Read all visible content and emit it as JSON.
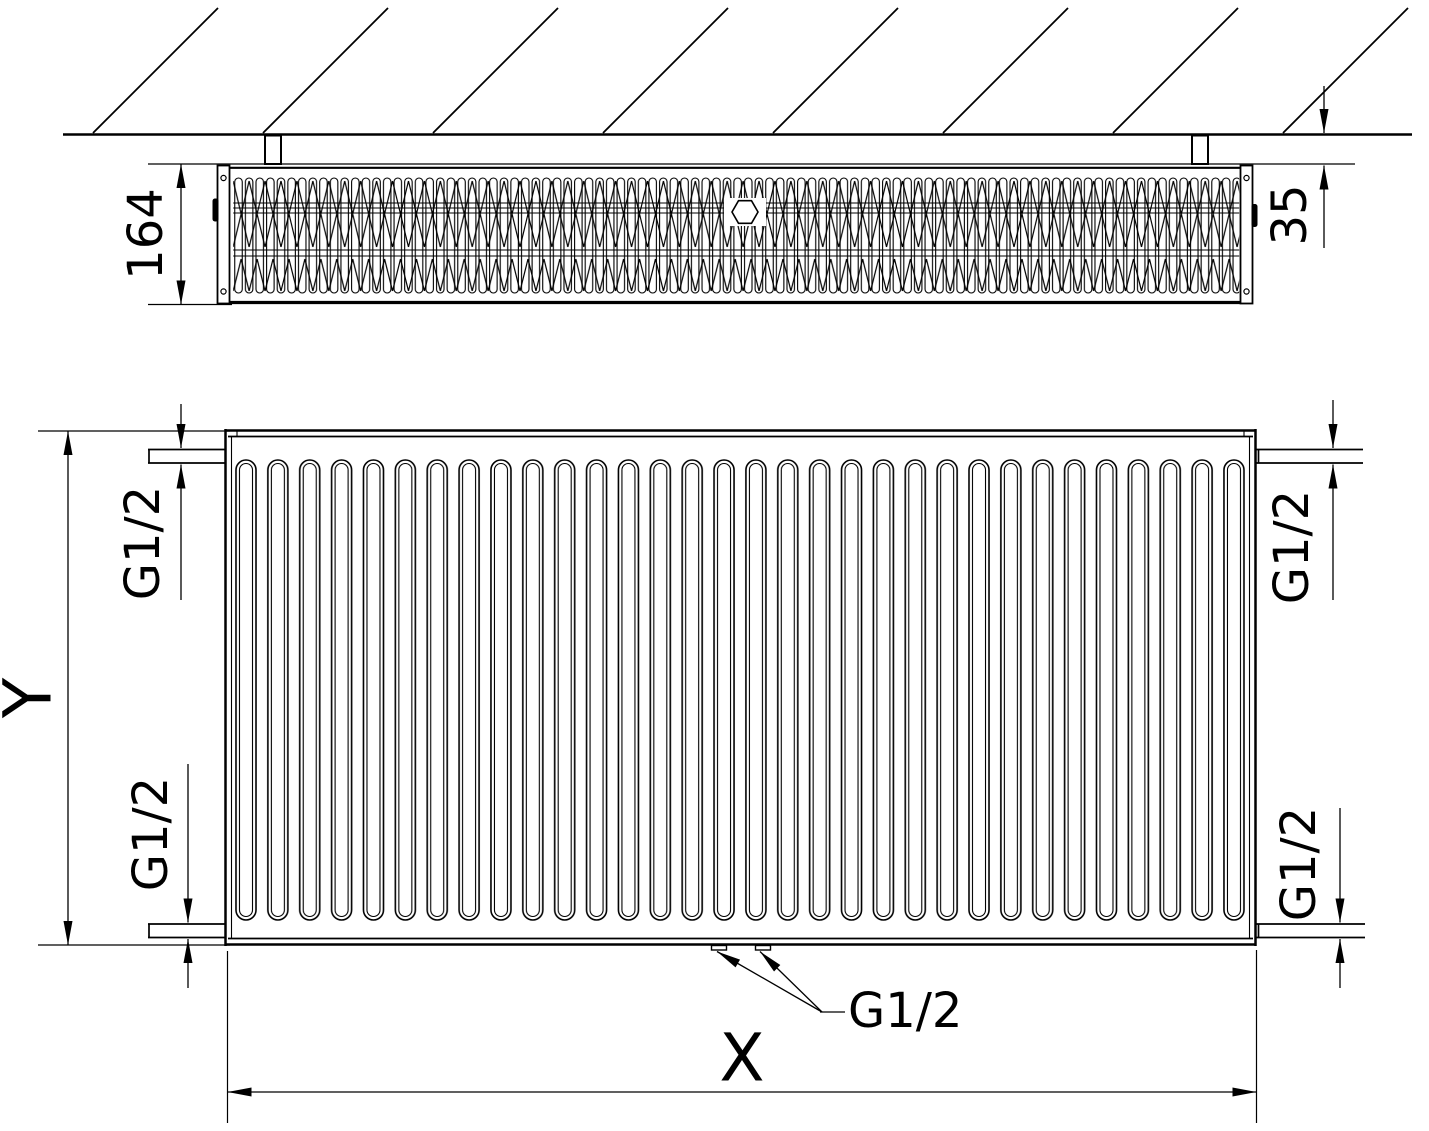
{
  "drawing": {
    "ink_color": "#000000",
    "background_color": "#ffffff",
    "top_view": {
      "depth_dimension": {
        "label": "164"
      },
      "wall_offset_dimension": {
        "label": "35"
      }
    },
    "front_view": {
      "height_dimension": {
        "label": "Y"
      },
      "width_dimension": {
        "label": "X"
      },
      "connection_top_left": {
        "label": "G1/2"
      },
      "connection_top_right": {
        "label": "G1/2"
      },
      "connection_bottom_left": {
        "label": "G1/2"
      },
      "connection_bottom_right": {
        "label": "G1/2"
      },
      "connection_bottom_center": {
        "label": "G1/2"
      }
    }
  }
}
